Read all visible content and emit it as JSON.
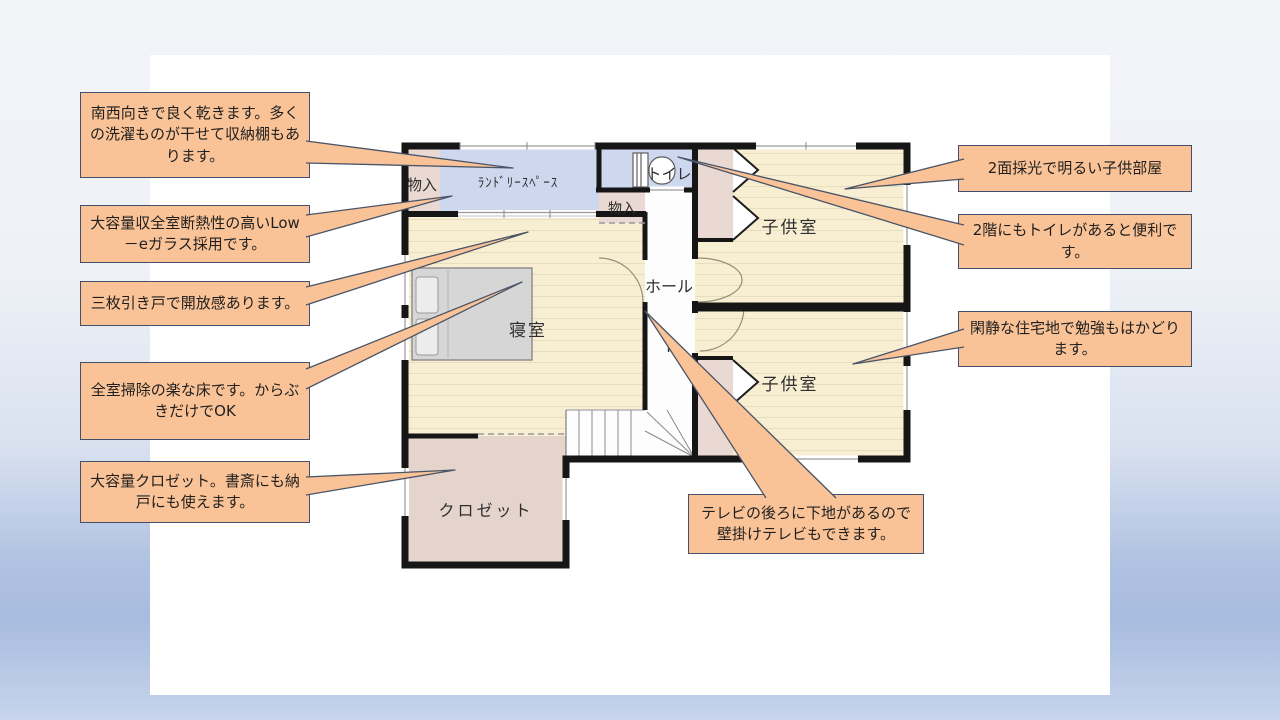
{
  "slide": {
    "type": "floor-plan-presentation-slide"
  },
  "colors": {
    "callout_fill": "#fac397",
    "callout_border": "#44506b",
    "floor_cream": "#f8efd3",
    "floor_stripe": "#e7ddbf",
    "room_blue": "#cdd7ee",
    "room_pink": "#ead9d3",
    "closet_room_pink": "#e4d4cb",
    "wall_black": "#161616",
    "bed_gray": "#d6d6d6",
    "background_blue": "#a8bcdf"
  },
  "callouts": {
    "laundry_note": {
      "text": "南西向きで良く乾きます。多くの洗濯ものが干せて収納棚もあります。"
    },
    "lowe_glass_note": {
      "text": "大容量収全室断熱性の高いLow－eガラス採用です。"
    },
    "sliding_door_note": {
      "text": "三枚引き戸で開放感あります。"
    },
    "floor_note": {
      "text": "全室掃除の楽な床です。からぶきだけでOK"
    },
    "closet_note": {
      "text": "大容量クロゼット。書斎にも納戸にも使えます。"
    },
    "kids_light_note": {
      "text": "2面採光で明るい子供部屋"
    },
    "toilet_note": {
      "text": "2階にもトイレがあると便利です。"
    },
    "quiet_note": {
      "text": "閑静な住宅地で勉強もはかどります。"
    },
    "tv_note": {
      "text": "テレビの後ろに下地があるので壁掛けテレビもできます。"
    }
  },
  "plan": {
    "labels": {
      "storage1": {
        "text": "物入"
      },
      "laundry": {
        "text": "ﾗﾝﾄﾞﾘｰｽﾍﾟｰｽ"
      },
      "toilet": {
        "text": "トイレ"
      },
      "storage2": {
        "text": "物入"
      },
      "kids_room_upper": {
        "text": "子供室"
      },
      "hall": {
        "text": "ホール"
      },
      "north": {
        "text": "N"
      },
      "kids_room_lower": {
        "text": "子供室"
      },
      "bedroom": {
        "text": "寝室"
      },
      "closet": {
        "text": "クロゼット"
      }
    }
  }
}
